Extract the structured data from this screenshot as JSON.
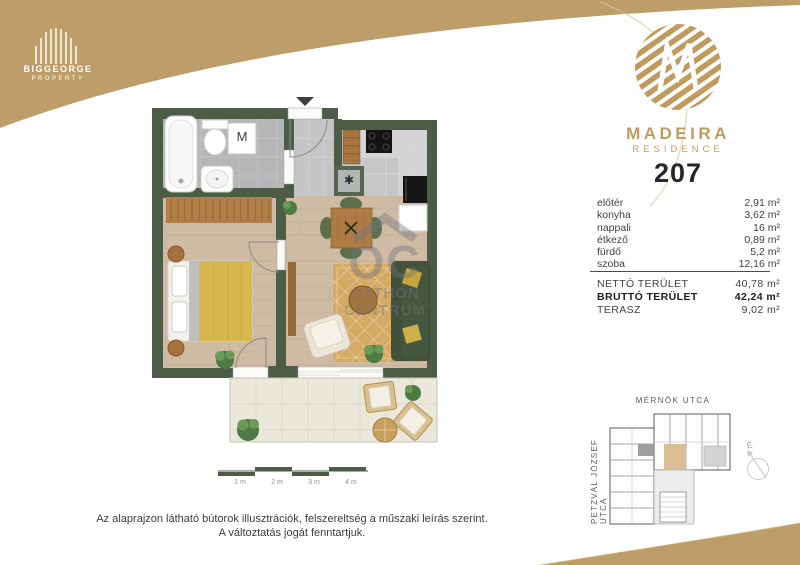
{
  "brand": {
    "biggeorge": {
      "name": "BIGGEORGE",
      "sub": "PROPERTY"
    },
    "madeira": {
      "name": "MADEIRA",
      "sub": "RESIDENCE"
    }
  },
  "unit": {
    "number": "207"
  },
  "rooms": [
    {
      "label": "előtér",
      "value": "2,91 m²"
    },
    {
      "label": "konyha",
      "value": "3,62 m²"
    },
    {
      "label": "nappali",
      "value": "16 m²"
    },
    {
      "label": "étkező",
      "value": "0,89 m²"
    },
    {
      "label": "fürdő",
      "value": "5,2 m²"
    },
    {
      "label": "szoba",
      "value": "12,16 m²"
    }
  ],
  "totals": [
    {
      "label": "NETTÓ TERÜLET",
      "value": "40,78 m²"
    },
    {
      "label": "BRUTTÓ TERÜLET",
      "value": "42,24 m²"
    },
    {
      "label": "TERASZ",
      "value": "9,02 m²"
    }
  ],
  "floorplan": {
    "washer_label": "M",
    "appliance_symbol": "✱"
  },
  "scalebar": {
    "labels": [
      "1 m",
      "2 m",
      "3 m",
      "4 m"
    ]
  },
  "siteplan": {
    "street_top": "MÉRNÖK UTCA",
    "street_left": "PETZVÁL JÓZSEF UTCA",
    "compass_label": "É"
  },
  "watermark": {
    "mark": "OC",
    "line1": "OTTHON",
    "line2": "CENTRUM"
  },
  "footer": {
    "line1": "Az alaprajzon látható bútorok illusztrációk, felszereltség a műszaki leírás szerint.",
    "line2": "A változtatás jogát fenntartjuk."
  },
  "colors": {
    "gold": "#bd9d68",
    "logo_gold": "#c19b5e",
    "wall_green": "#4d5c46",
    "highlight_tan": "#d9bc8e"
  }
}
